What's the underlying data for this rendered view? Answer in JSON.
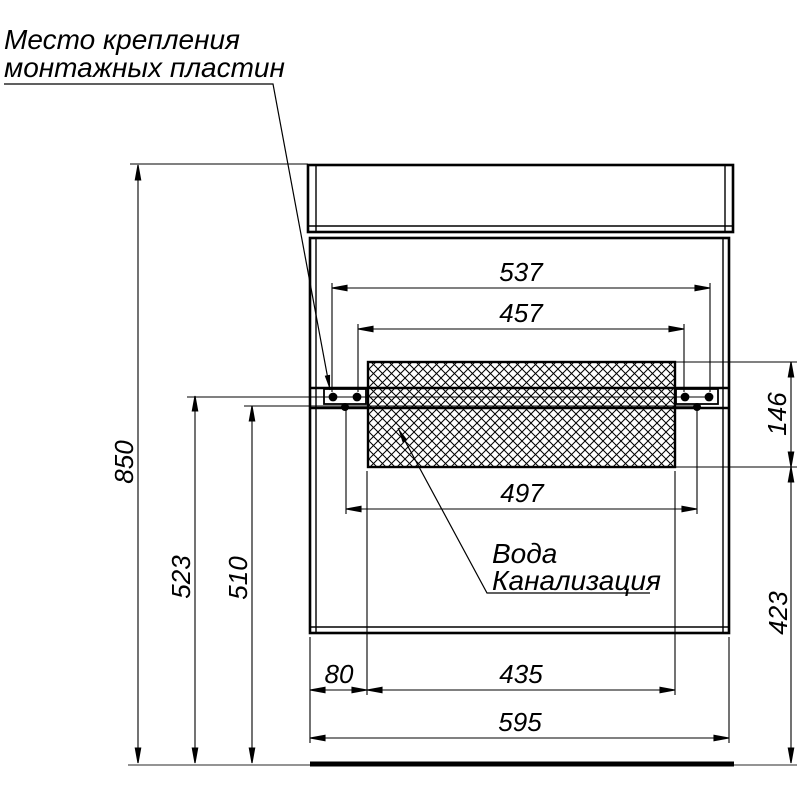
{
  "drawing": {
    "note_mounting": {
      "line1": "Место крепления",
      "line2": "монтажных пластин"
    },
    "utilities": {
      "line1": "Вода",
      "line2": "Канализация"
    },
    "dims": {
      "overall_height": "850",
      "plate_screw_height": "523",
      "rail_height": "510",
      "outer_screw_span": "537",
      "inner_screw_span": "457",
      "lower_screw_span": "497",
      "utility_zone_height": "146",
      "utility_zone_floor_offset": "423",
      "side_offset": "80",
      "utility_zone_width": "435",
      "cabinet_width": "595"
    },
    "colors": {
      "line": "#000000",
      "background": "#ffffff",
      "floor_thin": "#555555"
    }
  }
}
